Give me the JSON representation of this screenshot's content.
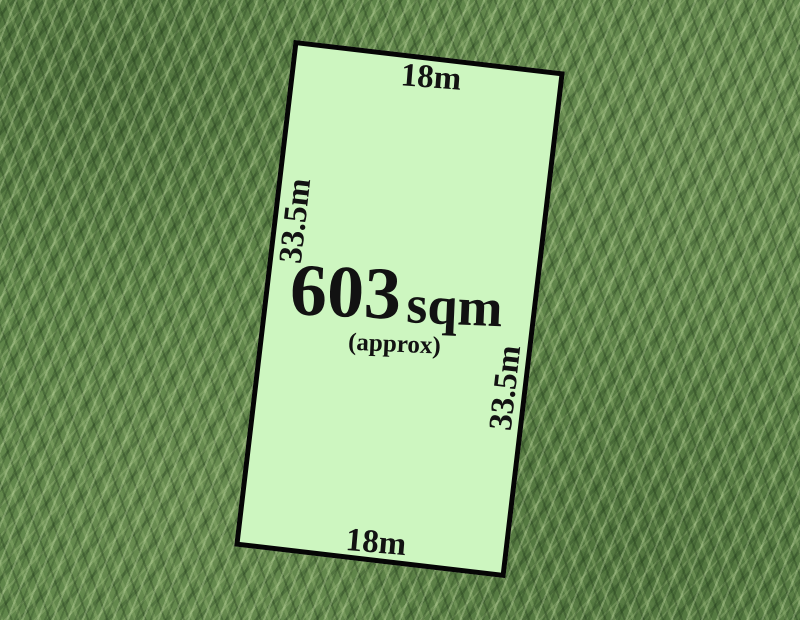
{
  "parcel": {
    "area": {
      "value": "603",
      "unit": "sqm",
      "qualifier": "(approx)"
    },
    "dimensions": {
      "top": "18m",
      "bottom": "18m",
      "left": "33.5m",
      "right": "33.5m"
    },
    "colors": {
      "fill": "#cdf6c0",
      "border": "#050505",
      "text": "#121212"
    }
  },
  "background": {
    "colors": {
      "grass_base": "#5f8549",
      "grass_light": "#9cb985",
      "grass_dark": "#2e4a26"
    }
  }
}
